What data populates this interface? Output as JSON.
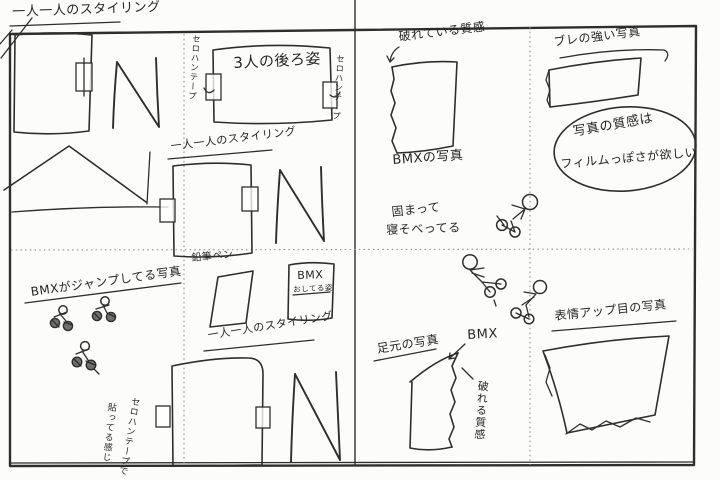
{
  "colors": {
    "paper": "#fcfcfa",
    "ink": "#2e2e2e",
    "guide_dotted": "#8f8f8f"
  },
  "title": "一人一人のスタイリング",
  "left_page": {
    "styling_caption_mid": "一人一人のスタイリング",
    "styling_caption_bottom": "一人一人のスタイリング",
    "three_people_caption": "3人の後ろ姿",
    "tape_label_left": "セロハンテープ",
    "tape_label_right": "セロハンテープ",
    "pen_note": "鉛筆ペン",
    "bmx_pose_title": "BMX",
    "bmx_pose_sub": "おしてる姿",
    "bmx_jump_caption": "BMXがジャンプしてる写真",
    "tape_feel_note_line1": "セロハンテープで",
    "tape_feel_note_line2": "貼ってる感じ"
  },
  "right_page": {
    "torn_top_note": "破れている質感",
    "bmx_photo_caption": "BMXの写真",
    "huddle_note_line1": "固まって",
    "huddle_note_line2": "寝そべってる",
    "bmx_pointer_label": "BMX",
    "feet_photo_caption": "足元の写真",
    "torn_texture_note": "破れる質感",
    "face_closeup_caption": "表情アップ目の写真",
    "blur_photo_caption": "ブレの強い写真",
    "film_texture_note_line1": "写真の質感は",
    "film_texture_note_line2": "フィルムっぽさが欲しい"
  }
}
